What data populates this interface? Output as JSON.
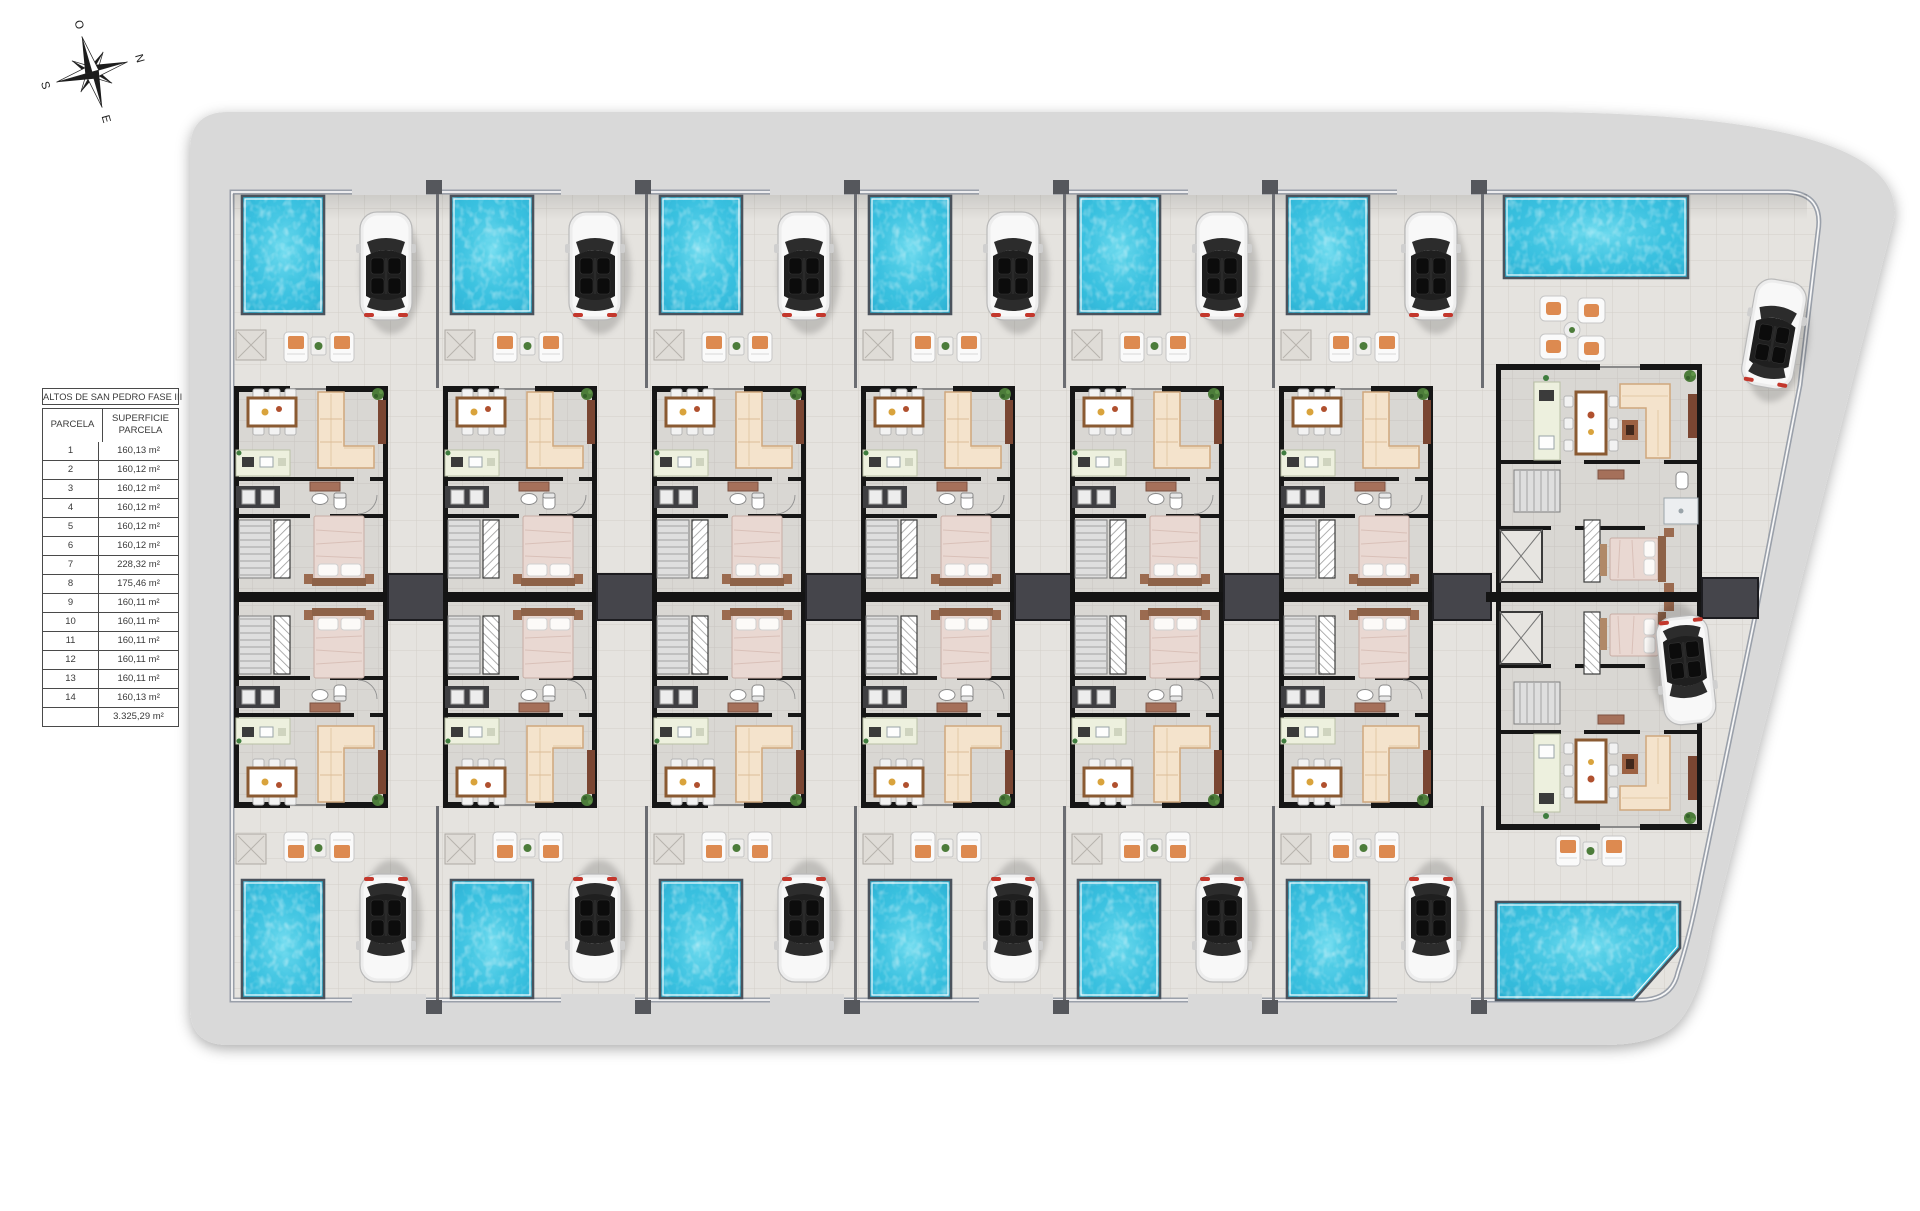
{
  "compass": {
    "north": "N",
    "south": "S",
    "east": "E",
    "west": "O"
  },
  "table": {
    "title": "ALTOS DE SAN PEDRO FASE III",
    "headers": {
      "parcela": "PARCELA",
      "superficie": "SUPERFICIE PARCELA"
    },
    "rows": [
      {
        "parcela": "1",
        "superficie": "160,13 m²"
      },
      {
        "parcela": "2",
        "superficie": "160,12 m²"
      },
      {
        "parcela": "3",
        "superficie": "160,12 m²"
      },
      {
        "parcela": "4",
        "superficie": "160,12 m²"
      },
      {
        "parcela": "5",
        "superficie": "160,12 m²"
      },
      {
        "parcela": "6",
        "superficie": "160,12 m²"
      },
      {
        "parcela": "7",
        "superficie": "228,32 m²"
      },
      {
        "parcela": "8",
        "superficie": "175,46 m²"
      },
      {
        "parcela": "9",
        "superficie": "160,11 m²"
      },
      {
        "parcela": "10",
        "superficie": "160,11 m²"
      },
      {
        "parcela": "11",
        "superficie": "160,11 m²"
      },
      {
        "parcela": "12",
        "superficie": "160,11 m²"
      },
      {
        "parcela": "13",
        "superficie": "160,11 m²"
      },
      {
        "parcela": "14",
        "superficie": "160,13 m²"
      }
    ],
    "total": "3.325,29 m²"
  },
  "plan": {
    "villa_columns": 6,
    "wide_parcels": 2,
    "pools": 14,
    "cars": 14,
    "colors": {
      "road": "#d9d9d9",
      "site_floor": "#e5e3df",
      "tile_line": "#d2cfc9",
      "interior_floor": "#d9d7d3",
      "interior_line": "#c9c6c1",
      "wall": "#161616",
      "boundary": "#9aa0aa",
      "connector": "#45454b",
      "pool": "#31b9dc",
      "pool_deep": "#1796bd",
      "car_body": "#ededed",
      "sofa": "#f4e3cc",
      "wood": "#8a5a32",
      "wood_dark": "#7a4632",
      "terracotta": "#dd8a50",
      "green": "#4c7c3a",
      "kitchen": "#edf0de",
      "bed": "#e9d8d2",
      "headboard": "#8d6248",
      "cabinet": "#a5705a"
    }
  }
}
